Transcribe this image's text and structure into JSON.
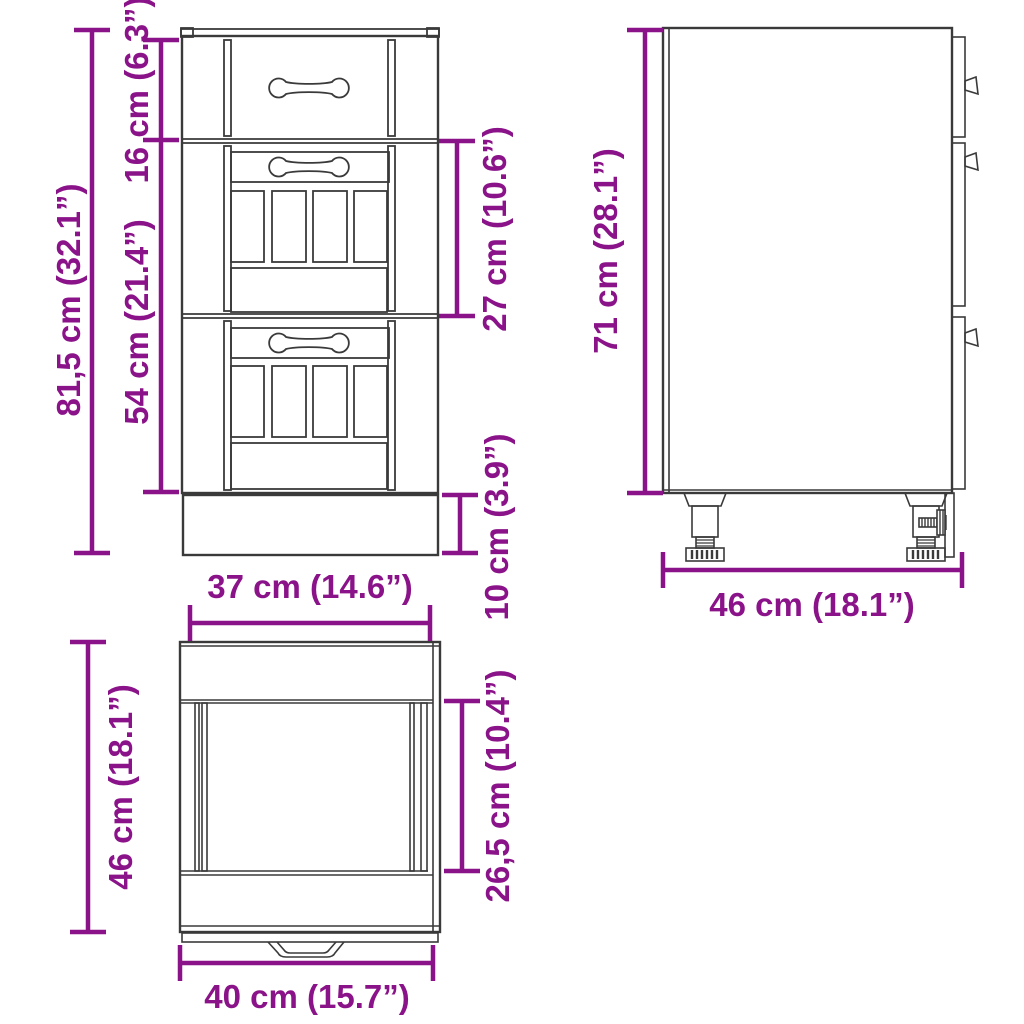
{
  "title": "Drawer base cabinet dimension diagram",
  "colors": {
    "dimension": "#8B1389",
    "line": "#3A3A3A",
    "background": "#FFFFFF"
  },
  "views": {
    "front": {
      "name": "front-view",
      "labels": {
        "total_height": "81,5 cm (32.1”)",
        "top_drawer_height": "16 cm (6.3”)",
        "lower_section_height": "54 cm (21.4”)",
        "middle_drawer_height": "27 cm (10.6”)",
        "plinth_height": "10 cm (3.9”)",
        "width": "37 cm (14.6”)"
      }
    },
    "side": {
      "name": "side-view",
      "labels": {
        "body_height": "71 cm (28.1”)",
        "depth": "46 cm (18.1”)"
      }
    },
    "bottom": {
      "name": "bottom-view",
      "labels": {
        "depth": "46 cm (18.1”)",
        "inner_depth": "26,5 cm (10.4”)",
        "width": "40 cm (15.7”)"
      }
    }
  }
}
